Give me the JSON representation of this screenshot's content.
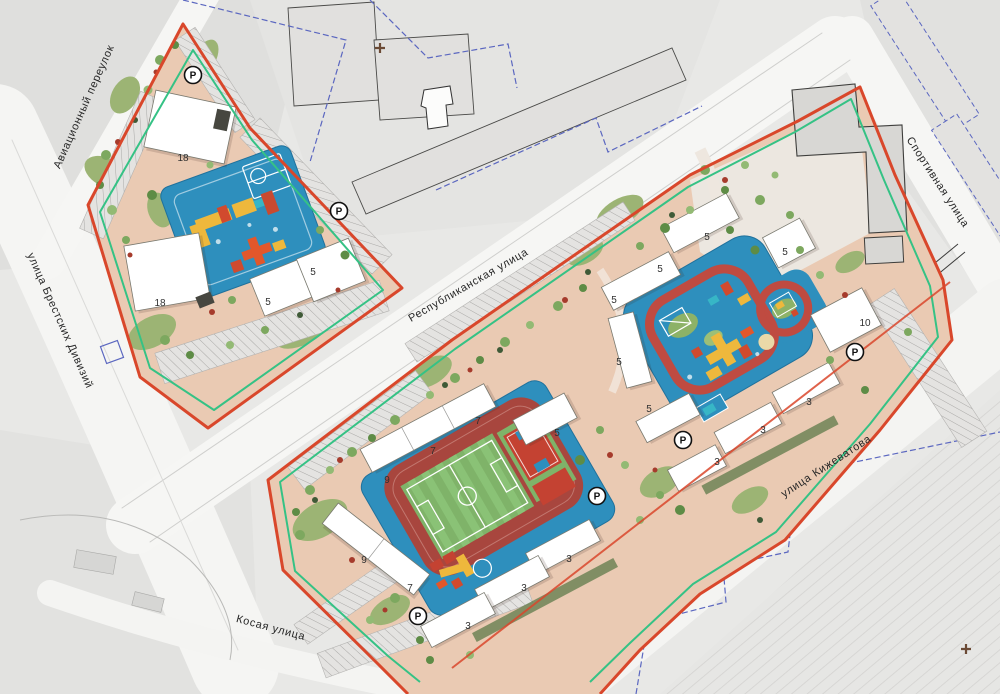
{
  "plan": {
    "title": "Генплан жилой застройки",
    "streets": [
      {
        "label": "Авиационный переулок"
      },
      {
        "label": "улица Брестских Дивизий"
      },
      {
        "label": "Республиканская улица"
      },
      {
        "label": "Спортивная улица"
      },
      {
        "label": "улица Кижеватова"
      },
      {
        "label": "Косая улица"
      }
    ],
    "buildings": [
      {
        "label": "18"
      },
      {
        "label": "18"
      },
      {
        "label": "5"
      },
      {
        "label": "5"
      },
      {
        "label": "7"
      },
      {
        "label": "7"
      },
      {
        "label": "5"
      },
      {
        "label": "9"
      },
      {
        "label": "9"
      },
      {
        "label": "7"
      },
      {
        "label": "5"
      },
      {
        "label": "5"
      },
      {
        "label": "5"
      },
      {
        "label": "5"
      },
      {
        "label": "5"
      },
      {
        "label": "5"
      },
      {
        "label": "10"
      },
      {
        "label": "3"
      },
      {
        "label": "3"
      },
      {
        "label": "3"
      },
      {
        "label": "3"
      },
      {
        "label": "3"
      },
      {
        "label": "3"
      }
    ],
    "parking": {
      "letter": "P"
    },
    "colors": {
      "boundary_red": "#d9472b",
      "boundary_green": "#35c285",
      "playground_blue": "#2e8fbd",
      "field_green": "#7fb369",
      "track_red": "#a8463e",
      "court_red": "#c44232",
      "equipment_yellow": "#eeb83c",
      "equipment_orange": "#e2572b",
      "parcel_blue": "#5b67c0",
      "ground_pink": "#eacab3",
      "lawn_green": "#9cb474"
    }
  }
}
